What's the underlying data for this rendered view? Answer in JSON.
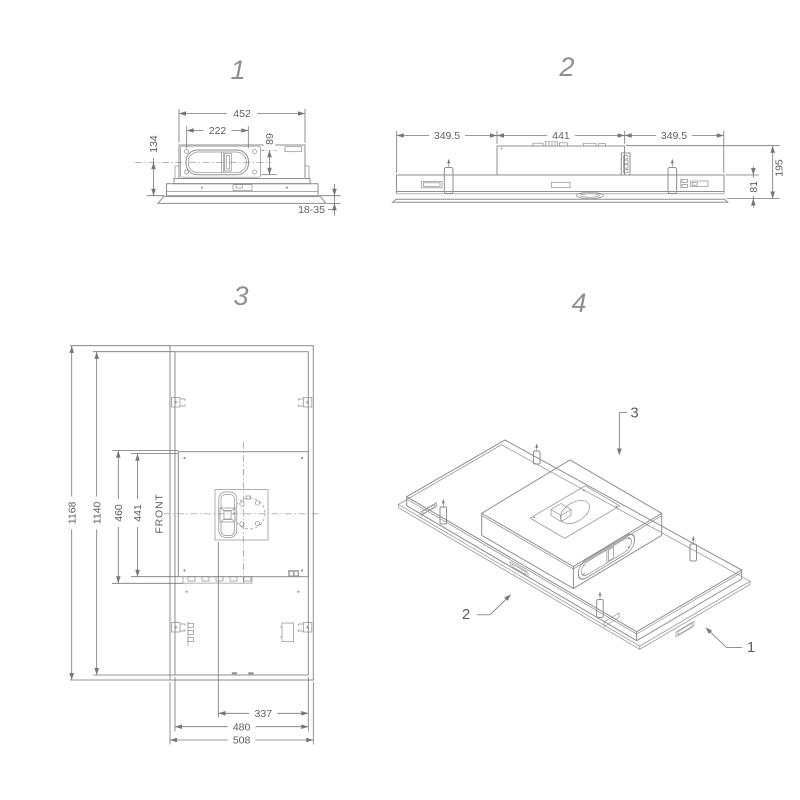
{
  "colors": {
    "line-color": "#8e8e8e",
    "dim-color": "#767676",
    "text-color": "#5f5f5f",
    "label-color": "#8f8f8f",
    "bg-color": "#ffffff"
  },
  "view1": {
    "label": "1",
    "dim_width": "452",
    "dim_duct_width": "222",
    "dim_duct_height": "89",
    "dim_height": "134",
    "dim_ceiling_thickness": "18-35"
  },
  "view2": {
    "label": "2",
    "dim_left_span": "349.5",
    "dim_center_span": "441",
    "dim_right_span": "349.5",
    "dim_total_height": "195",
    "dim_body_height": "81"
  },
  "view3": {
    "label": "3",
    "dim_total_length": "1168",
    "dim_body_length": "1140",
    "dim_frame_width": "460",
    "dim_box_width": "441",
    "front_label": "FRONT",
    "dim_duct_offset": "337",
    "dim_body_width": "480",
    "dim_total_width": "508"
  },
  "view4": {
    "label": "4",
    "callout_motor_box": "3",
    "callout_body": "2",
    "callout_ceiling_panel": "1"
  }
}
